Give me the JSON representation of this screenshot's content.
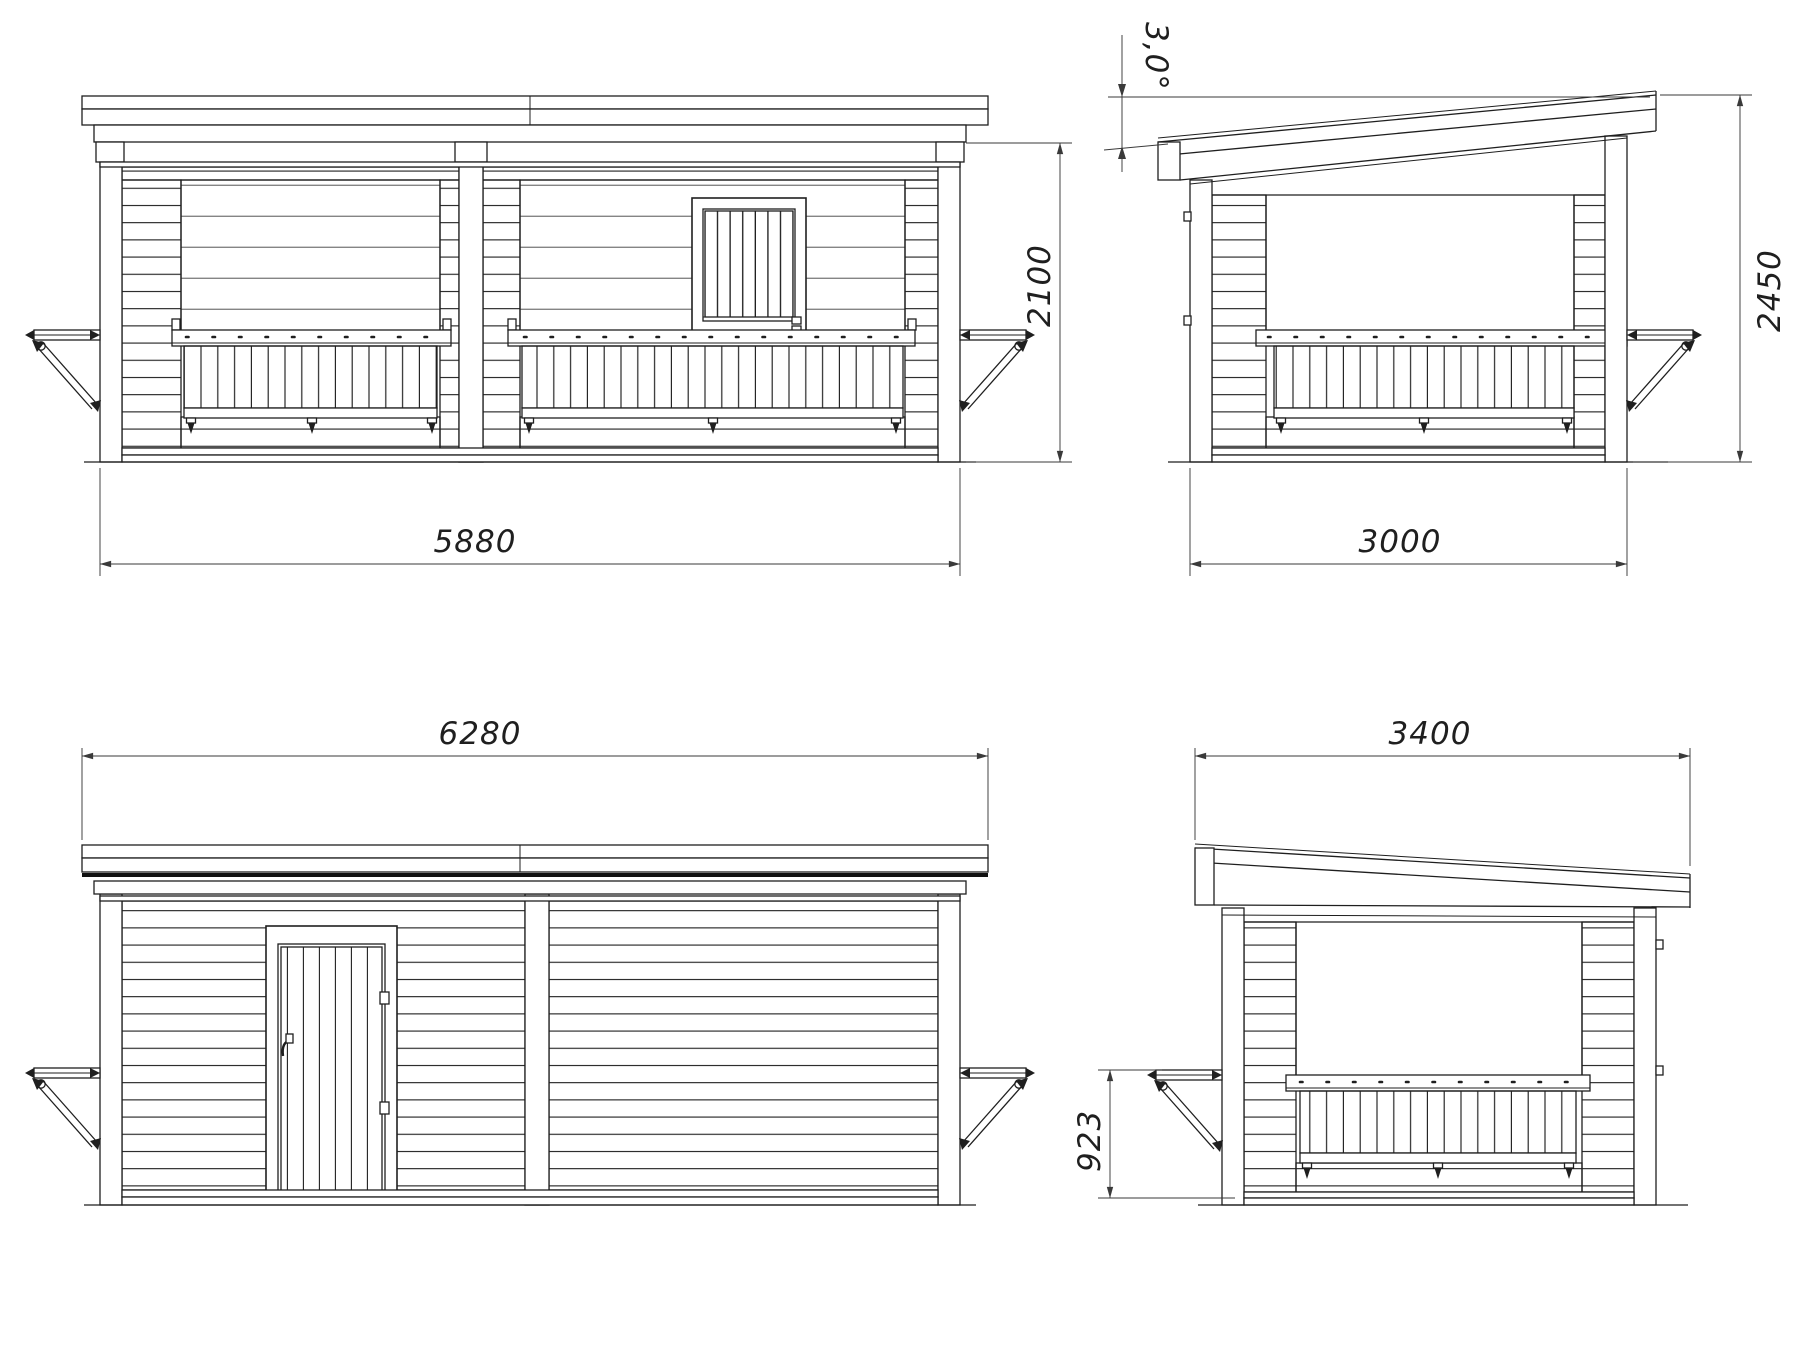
{
  "canvas": {
    "background": "#ffffff",
    "line_color": "#1f1f1f",
    "dimension_color": "#3a3a3a"
  },
  "views": {
    "front": {
      "overall_width_mm": "5880",
      "wall_height_mm": "2100"
    },
    "side_right": {
      "wall_depth_mm": "3000",
      "overall_height_mm": "2450",
      "roof_slope": "3,0°"
    },
    "rear": {
      "overall_width_mm": "6280"
    },
    "side_left": {
      "roof_depth_mm": "3400",
      "hatch_shelf_height_mm": "923"
    }
  }
}
